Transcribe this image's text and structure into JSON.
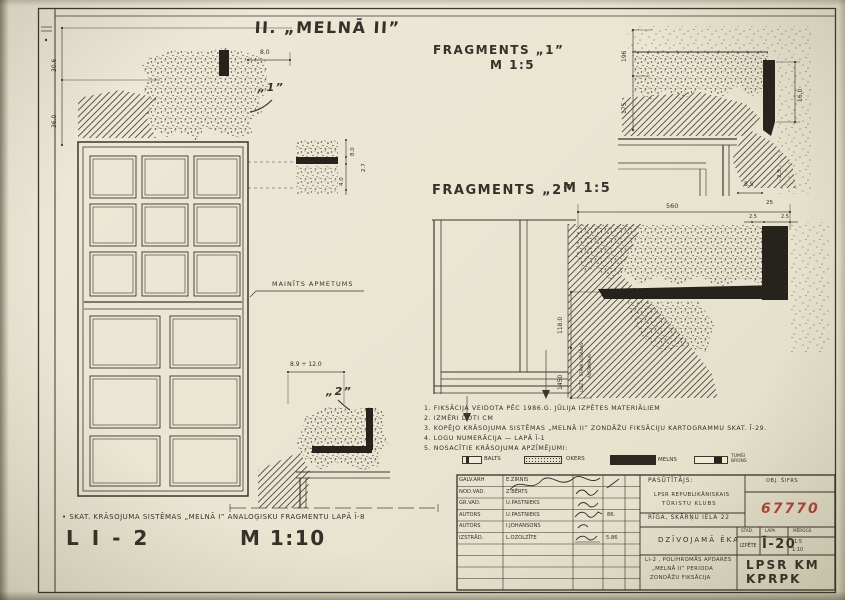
{
  "titles": {
    "main": "II. „MELNĀ II”",
    "frag1": "FRAGMENTS „1”",
    "frag1_scale": "M 1:5",
    "frag2": "FRAGMENTS „2”",
    "frag2_scale": "M 1:5",
    "sheet_code": "L I - 2",
    "sheet_scale": "M 1:10"
  },
  "labels": {
    "mainits": "MAINĪTS APMETUMS",
    "marker1": "„1”",
    "marker2": "„2”",
    "bottom_ref": "• SKAT. KRĀSOJUMA SISTĒMAS „MELNĀ I” ANALOĢISKU FRAGMENTU LAPĀ Ī-8"
  },
  "dims": {
    "w1": "30.6",
    "w2": "36.0",
    "w3": "8.0",
    "d1_a": "8.0",
    "d1_b": "2.7",
    "d1_c": "4.0",
    "d2_range": "8.9 ÷ 12.0",
    "f1_a": "196",
    "f1_b": "175",
    "f1_c": "16,0",
    "f1_d": "8.5",
    "f1_e": "2.5",
    "f2_top": "560",
    "f2_a": "25",
    "f2_b": "2.5",
    "f2_c": "2.5",
    "f2_h1": "118.0",
    "f2_h2": "1450",
    "f2_note1": "LĪDZ 1. STĀVA LOGAILAS",
    "f2_note2": "AUGŠMALAI"
  },
  "notes": {
    "n1": "1. FIKSĀCIJA VEIDOTA PĒC 1986.G. JŪLIJA IZPĒTES MATERIĀLIEM",
    "n2": "2. IZMĒRI DOTI CM",
    "n3": "3. KOPĒJO KRĀSOJUMA SISTĒMAS „MELNĀ II” ZONDĀŽU FIKSĀCIJU KARTOGRAMMU SKAT. Ī-29.",
    "n4": "4. LOGU NUMERĀCIJA — LAPĀ Ī-1",
    "n5": "5. NOSACĪTIE KRĀSOJUMA APZĪMĒJUMI:"
  },
  "legend": {
    "items": [
      {
        "label": "BALTS"
      },
      {
        "label": "OKERS"
      },
      {
        "label": "MELNS"
      },
      {
        "label": "TUMŠI BRŪNS"
      }
    ]
  },
  "titleblock": {
    "rows": [
      {
        "role": "GALV.ARH",
        "name": "E.ZIRNIS",
        "extra": ""
      },
      {
        "role": "NOD.VAD.",
        "name": "Z.BĒRTS",
        "extra": ""
      },
      {
        "role": "GR.VAD.",
        "name": "U.PASTNIEKS",
        "extra": ""
      },
      {
        "role": "AUTORS",
        "name": "U.PASTNIEKS",
        "extra": "86."
      },
      {
        "role": "AUTORS",
        "name": "I.JOHANSONS",
        "extra": ""
      },
      {
        "role": "IZSTRĀD.",
        "name": "L.OZOLZĪTE",
        "extra": "5.86"
      }
    ],
    "client_label": "PASŪTĪTĀJS:",
    "client_line1": "LPSR REPUBLIKĀNISKAIS",
    "client_line2": "TŪRISTU KLUBS",
    "address": "RĪGA, SKĀRŅU IELA 22",
    "obj_code_label": "OBJ. ŠIFRS",
    "obj_code": "67770",
    "building": "DZĪVOJAMĀ ĒKA",
    "col_stage": "STAD.",
    "col_sheet": "LAPA",
    "col_scale": "MĒROGS",
    "stage": "IZPĒTE",
    "sheet_no": "Ī-20",
    "scale1": "1:5",
    "scale2": "1:10",
    "project_line1": "LI-2 , POLIHROMĀS APDARES",
    "project_line2": "„MELNĀ II”  PERIODA",
    "project_line3": "ZONDĀŽU  FIKSĀCIJA",
    "org_line1": "LPSR  KM",
    "org_line2": "KPRPK",
    "accent_red": "#b0453a"
  }
}
